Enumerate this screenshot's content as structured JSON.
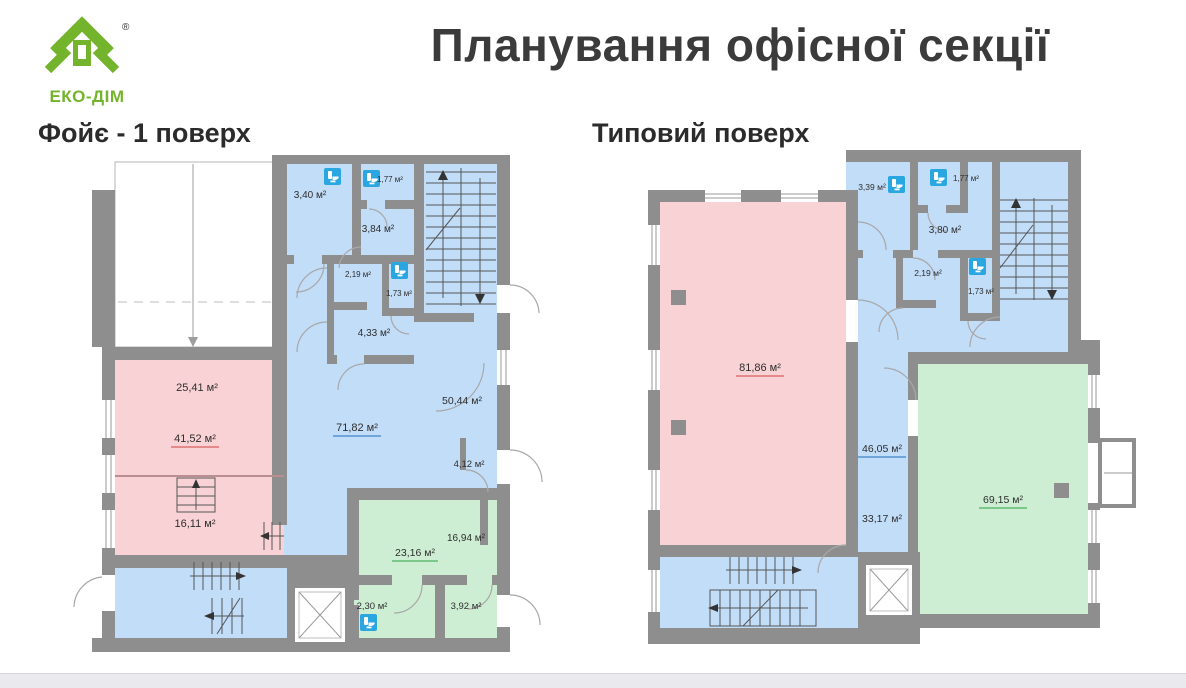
{
  "logo": {
    "name": "ЕКО-ДІМ",
    "registered": "®"
  },
  "title": "Планування офісної секції",
  "plans": [
    {
      "title": "Фойє - 1 поверх",
      "rooms": [
        {
          "area": "3,40 м²",
          "zone": "blue",
          "wc": true
        },
        {
          "area": "1,77 м²",
          "zone": "blue",
          "wc": true
        },
        {
          "area": "3,84 м²",
          "zone": "blue"
        },
        {
          "area": "2,19 м²",
          "zone": "blue"
        },
        {
          "area": "1,73 м²",
          "zone": "blue",
          "wc": true
        },
        {
          "area": "4,33 м²",
          "zone": "blue"
        },
        {
          "area": "25,41 м²",
          "zone": "pink"
        },
        {
          "area": "41,52 м²",
          "zone": "pink",
          "underline": "red"
        },
        {
          "area": "16,11 м²",
          "zone": "pink"
        },
        {
          "area": "71,82 м²",
          "zone": "blue",
          "underline": "blue"
        },
        {
          "area": "50,44 м²",
          "zone": "blue"
        },
        {
          "area": "4,12 м²",
          "zone": "blue"
        },
        {
          "area": "23,16 м²",
          "zone": "green",
          "underline": "green"
        },
        {
          "area": "16,94 м²",
          "zone": "green"
        },
        {
          "area": "2,30 м²",
          "zone": "green",
          "wc": true
        },
        {
          "area": "3,92 м²",
          "zone": "green"
        }
      ]
    },
    {
      "title": "Типовий поверх",
      "rooms": [
        {
          "area": "3,39 м²",
          "zone": "blue",
          "wc": true
        },
        {
          "area": "1,77 м²",
          "zone": "blue",
          "wc": true
        },
        {
          "area": "3,80 м²",
          "zone": "blue"
        },
        {
          "area": "2,19 м²",
          "zone": "blue"
        },
        {
          "area": "1,73 м²",
          "zone": "blue",
          "wc": true
        },
        {
          "area": "81,86 м²",
          "zone": "pink",
          "underline": "red"
        },
        {
          "area": "46,05 м²",
          "zone": "blue",
          "underline": "blue"
        },
        {
          "area": "33,17 м²",
          "zone": "blue"
        },
        {
          "area": "69,15 м²",
          "zone": "green",
          "underline": "green"
        }
      ]
    }
  ],
  "colors": {
    "brand_green": "#74b42c",
    "wall_gray": "#8e8e8e",
    "room_blue": "#c2ddf8",
    "room_pink": "#f9d2d5",
    "room_green": "#cdeed3",
    "wc_icon_blue": "#2aa7e0",
    "underline_red": "#d95f5f",
    "underline_blue": "#4184c7",
    "underline_green": "#4db05e",
    "title_text": "#3b3b3b"
  }
}
